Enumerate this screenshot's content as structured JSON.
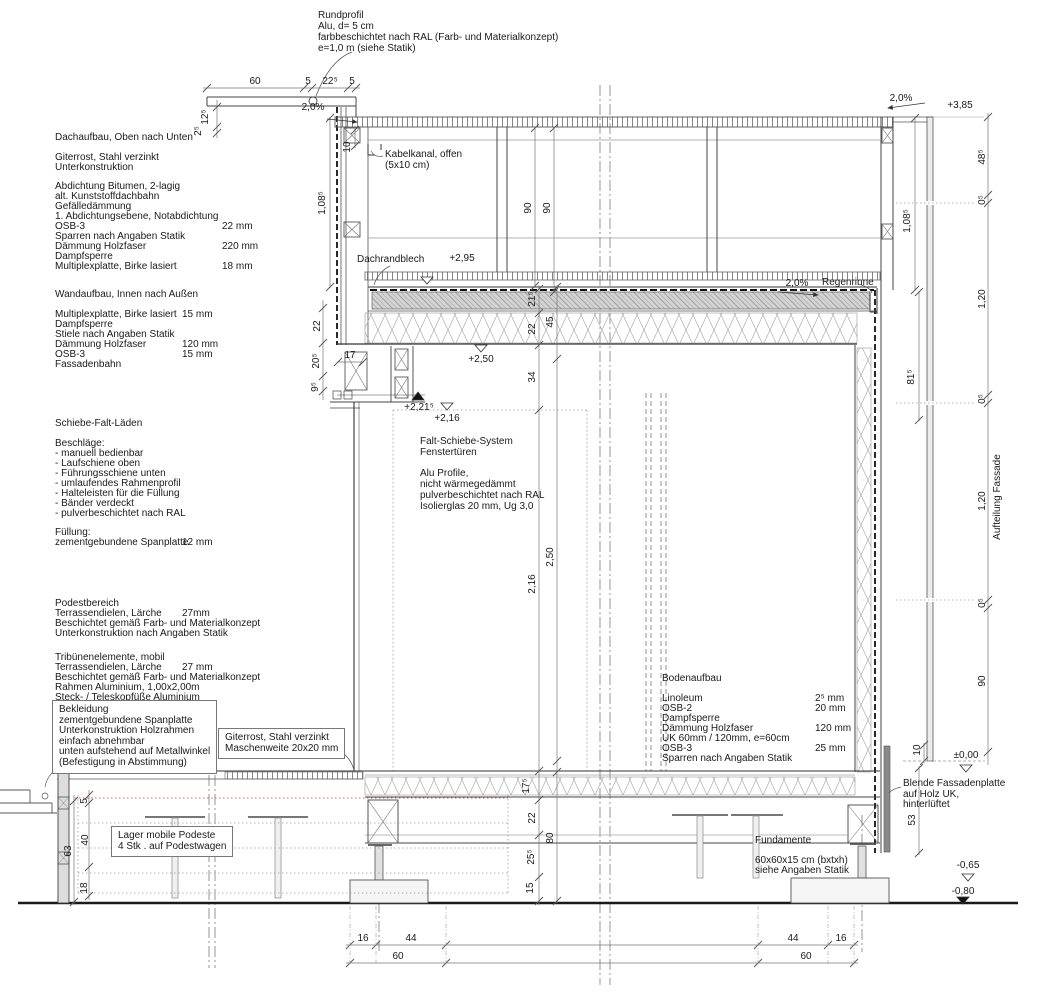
{
  "notes": {
    "rundprofil": [
      "Rundprofil",
      "Alu, d= 5 cm",
      "farbbeschichtet nach RAL (Farb- und Materialkonzept)",
      "e=1,0 m (siehe Statik)"
    ],
    "kabelkanal": [
      "Kabelkanal, offen",
      "(5x10 cm)"
    ],
    "dachrandblech": "Dachrandblech",
    "regenrinne": "Regenrinne",
    "falt": [
      "Falt-Schiebe-System",
      "Fenstertüren"
    ],
    "alu": [
      "Alu Profile,",
      "nicht wärmegedämmt",
      "pulverbeschichtet nach RAL",
      "Isolierglas 20 mm, Ug 3,0"
    ],
    "bekleidung": [
      "Bekleidung",
      "zementgebundene Spanplatte",
      "Unterkonstruktion Holzrahmen",
      "einfach abnehmbar",
      "unten aufstehend auf Metallwinkel",
      "(Befestigung in Abstimmung)"
    ],
    "giterrost_box": [
      "Giterrost, Stahl verzinkt",
      "Maschenweite 20x20 mm"
    ],
    "lager": [
      "Lager mobile Podeste",
      "4 Stk . auf Podestwagen"
    ],
    "blende": [
      "Blende Fassadenplatte",
      "auf Holz UK,",
      "hinterlüftet"
    ],
    "fundamente": [
      "Fundamente",
      "60x60x15 cm (bxtxh)",
      "siehe Angaben Statik"
    ],
    "aufteilung": "Aufteilung Fassade"
  },
  "blocks": {
    "dachaufbau": {
      "title": "Dachaufbau, Oben nach Unten",
      "rows": [
        [
          "Giterrost, Stahl verzinkt",
          ""
        ],
        [
          "Unterkonstruktion",
          ""
        ],
        [
          "Abdichtung Bitumen, 2-lagig",
          ""
        ],
        [
          "alt. Kunststoffdachbahn",
          ""
        ],
        [
          "Gefälledämmung",
          ""
        ],
        [
          "1. Abdichtungsebene, Notabdichtung",
          ""
        ],
        [
          "OSB-3",
          "22 mm"
        ],
        [
          "Sparren nach Angaben Statik",
          ""
        ],
        [
          "Dämmung Holzfaser",
          "220 mm"
        ],
        [
          "Dampfsperre",
          ""
        ],
        [
          "Multiplexplatte, Birke lasiert",
          "18 mm"
        ]
      ]
    },
    "wandaufbau": {
      "title": "Wandaufbau, Innen nach Außen",
      "rows": [
        [
          "Multiplexplatte, Birke lasiert",
          "15 mm"
        ],
        [
          "Dampfsperre",
          ""
        ],
        [
          "Stiele nach Angaben Statik",
          ""
        ],
        [
          "Dämmung Holzfaser",
          "120 mm"
        ],
        [
          "OSB-3",
          "15 mm"
        ],
        [
          "Fassadenbahn",
          ""
        ]
      ]
    },
    "laeden": {
      "title": "Schiebe-Falt-Läden",
      "sub": "Beschläge:",
      "items": [
        "- manuell bedienbar",
        "- Laufschiene oben",
        "- Führungsschiene unten",
        "- umlaufendes Rahmenprofil",
        "- Halteleisten für die Füllung",
        "- Bänder verdeckt",
        "- pulverbeschichtet nach RAL"
      ],
      "fuellung_title": "Füllung:",
      "fuellung_row": [
        "zementgebundene Spanplatte",
        "12 mm"
      ]
    },
    "podest": {
      "rows": [
        [
          "Podestbereich",
          ""
        ],
        [
          "Terrassendielen, Lärche",
          "27mm"
        ],
        [
          "Beschichtet gemäß Farb- und Materialkonzept",
          ""
        ],
        [
          "Unterkonstruktion nach Angaben Statik",
          ""
        ]
      ]
    },
    "tribuene": {
      "rows": [
        [
          "Tribünenelemente, mobil",
          ""
        ],
        [
          "Terrassendielen, Lärche",
          "27 mm"
        ],
        [
          "Beschichtet gemäß Farb- und Materialkonzept",
          ""
        ],
        [
          "Rahmen Aluminium, 1,00x2,00m",
          ""
        ],
        [
          "Steck- / Teleskopfüße Aluminium",
          ""
        ]
      ]
    },
    "boden": {
      "title": "Bodenaufbau",
      "rows": [
        [
          "Linoleum",
          "2⁵ mm"
        ],
        [
          "OSB-2",
          "20 mm"
        ],
        [
          "Dampfsperre",
          ""
        ],
        [
          "Dämmung Holzfaser",
          "120 mm"
        ],
        [
          "UK 60mm / 120mm, e=60cm",
          ""
        ],
        [
          "OSB-3",
          "25 mm"
        ],
        [
          "Sparren nach Angaben Statik",
          ""
        ]
      ]
    }
  },
  "dims": {
    "top": [
      "60",
      "5",
      "22⁵",
      "5"
    ],
    "tl": [
      "12⁵",
      "2⁵"
    ],
    "slope": "2,0%",
    "k10": "10",
    "h108l": "1,08⁵",
    "lchain": [
      "22",
      "20⁵",
      "9⁵"
    ],
    "w17": "17",
    "v90": [
      "90",
      "90"
    ],
    "roof": [
      "21⁵",
      "22",
      "45",
      "34"
    ],
    "t216": "2,16",
    "t250": "2,50",
    "floor": [
      "17⁵",
      "22",
      "25⁵",
      "15"
    ],
    "f80": "80",
    "bl": [
      "5",
      "40",
      "18"
    ],
    "bl63": "63",
    "botl": [
      "16",
      "44",
      "60"
    ],
    "botr": [
      "44",
      "16",
      "60"
    ],
    "right": [
      "48⁵",
      "0⁵",
      "1,20",
      "0⁵",
      "1,20",
      "0⁵",
      "90"
    ],
    "r108": "1,08⁵",
    "r81": "81⁵",
    "r10": "10",
    "r53": "53"
  },
  "levels": {
    "l385": "+3,85",
    "l295": "+2,95",
    "l250": "+2,50",
    "l2215": "+2,21⁵",
    "l216": "+2,16",
    "l000": "±0,00",
    "m065": "-0,65",
    "m080": "-0,80"
  }
}
